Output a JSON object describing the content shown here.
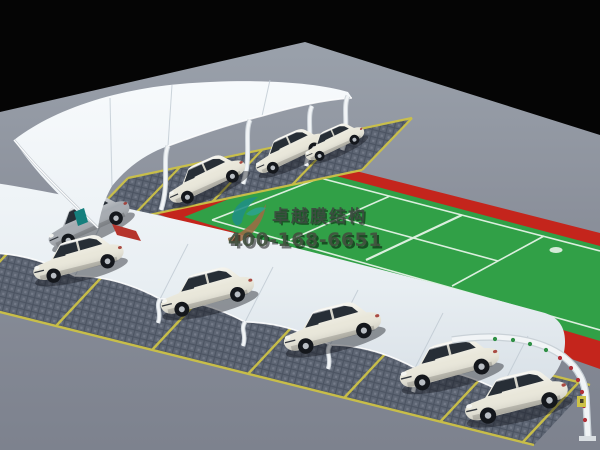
{
  "watermark": {
    "brand": "卓越膜结构",
    "phone": "400-168-6651",
    "logo": "teal-and-tan swoosh mark"
  },
  "scene": {
    "type": "3d-architectural-render",
    "subject": "membrane structure carports beside a green sports court",
    "court": "green court with white markings and red border",
    "white_car_count": 8,
    "gray_car_count": 1,
    "canopy_count": 2,
    "end_frame": "white arched steel gateway with perforation holes"
  },
  "colors": {
    "sky": "#050505",
    "ground_light": "#99a0aa",
    "ground_dark": "#7d828e",
    "court_green": "#31a047",
    "court_red": "#c4251c",
    "court_line": "#eaf6eb",
    "paving": "#5e6674",
    "paving_dot": "#4c5462",
    "stall_yellow": "#cdc247",
    "canopy_light": "#f6f9fb",
    "canopy_shade": "#d7dfe6",
    "canopy_seam": "#bfc9d2",
    "steel_white": "#f1f4f6",
    "steel_shadow": "#c9d1d7",
    "car_body": "#e9e7da",
    "car_gray": "#a6abb1",
    "glass_dark": "#272e36",
    "hole_green": "#2f8f45",
    "hole_red": "#b03038",
    "logo_teal": "#1f8f85",
    "logo_tan": "#9c6b44",
    "accent_teal": "#157f7d",
    "accent_red": "#b5342c",
    "brand_text": "#3c4a40",
    "phone_text": "#42513f"
  }
}
